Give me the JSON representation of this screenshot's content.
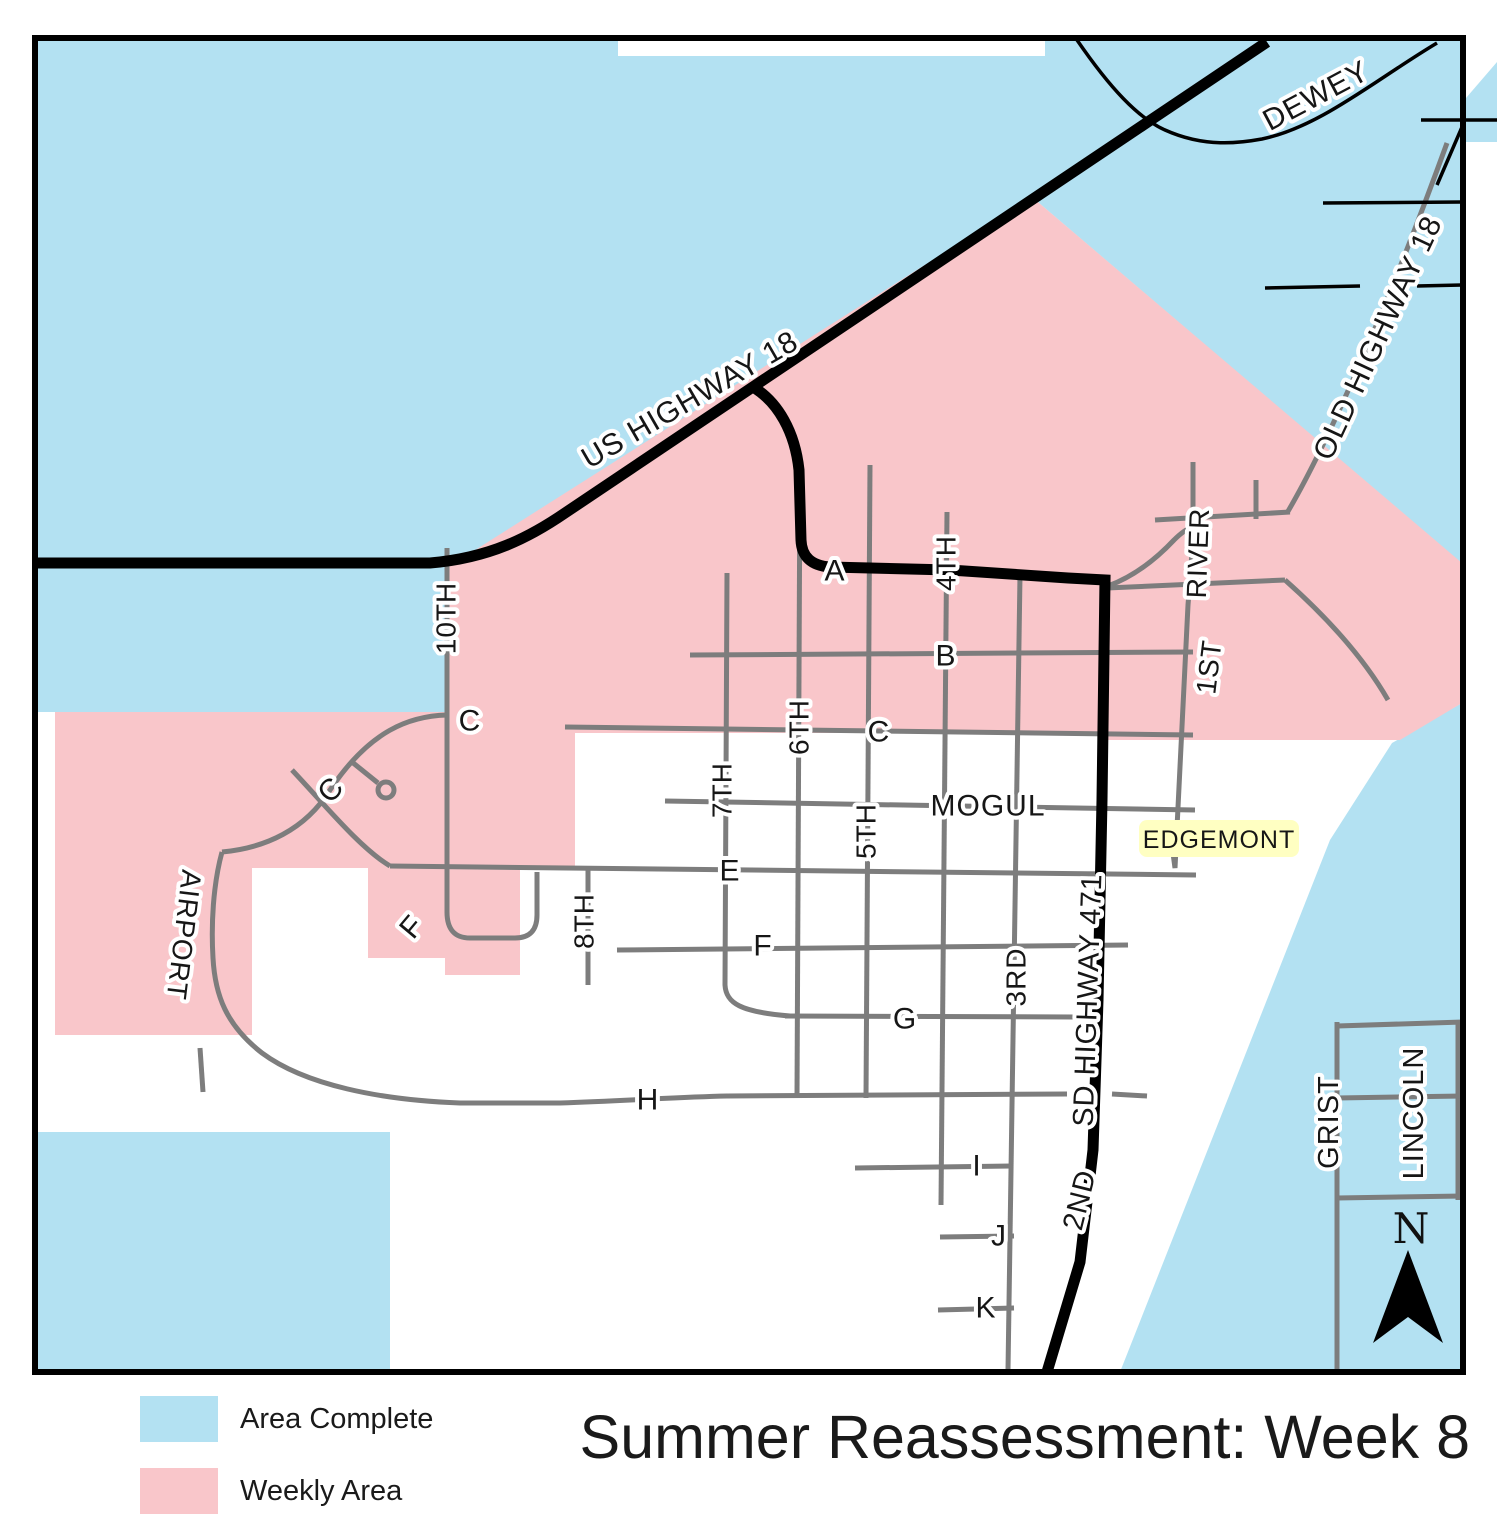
{
  "title": "Summer Reassessment: Week 8",
  "legend": {
    "items": [
      {
        "label": "Area Complete",
        "color": "#b3e1f2"
      },
      {
        "label": "Weekly Area",
        "color": "#f9c6ca"
      }
    ]
  },
  "colors": {
    "area_complete": "#b3e1f2",
    "weekly_area": "#f9c6ca",
    "road_gray": "#7d7d7d",
    "road_black": "#000000",
    "highlight_yellow": "#ffffc2",
    "label_ink": "#161616"
  },
  "compass": {
    "label": "N"
  },
  "map": {
    "labels": [
      {
        "text": "US HIGHWAY 18"
      },
      {
        "text": "DEWEY"
      },
      {
        "text": "OLD HIGHWAY 18"
      },
      {
        "text": "A"
      },
      {
        "text": "4TH"
      },
      {
        "text": "RIVER"
      },
      {
        "text": "B"
      },
      {
        "text": "1ST"
      },
      {
        "text": "10TH"
      },
      {
        "text": "C"
      },
      {
        "text": "C"
      },
      {
        "text": "C"
      },
      {
        "text": "7TH"
      },
      {
        "text": "6TH"
      },
      {
        "text": "5TH"
      },
      {
        "text": "MOGUL"
      },
      {
        "text": "EDGEMONT"
      },
      {
        "text": "AIRPORT"
      },
      {
        "text": "E"
      },
      {
        "text": "8TH"
      },
      {
        "text": "F"
      },
      {
        "text": "F"
      },
      {
        "text": "G"
      },
      {
        "text": "3RD"
      },
      {
        "text": "SD HIGHWAY 471"
      },
      {
        "text": "H"
      },
      {
        "text": "I"
      },
      {
        "text": "J"
      },
      {
        "text": "K"
      },
      {
        "text": "2ND"
      },
      {
        "text": "GRIST"
      },
      {
        "text": "LINCOLN"
      }
    ]
  }
}
